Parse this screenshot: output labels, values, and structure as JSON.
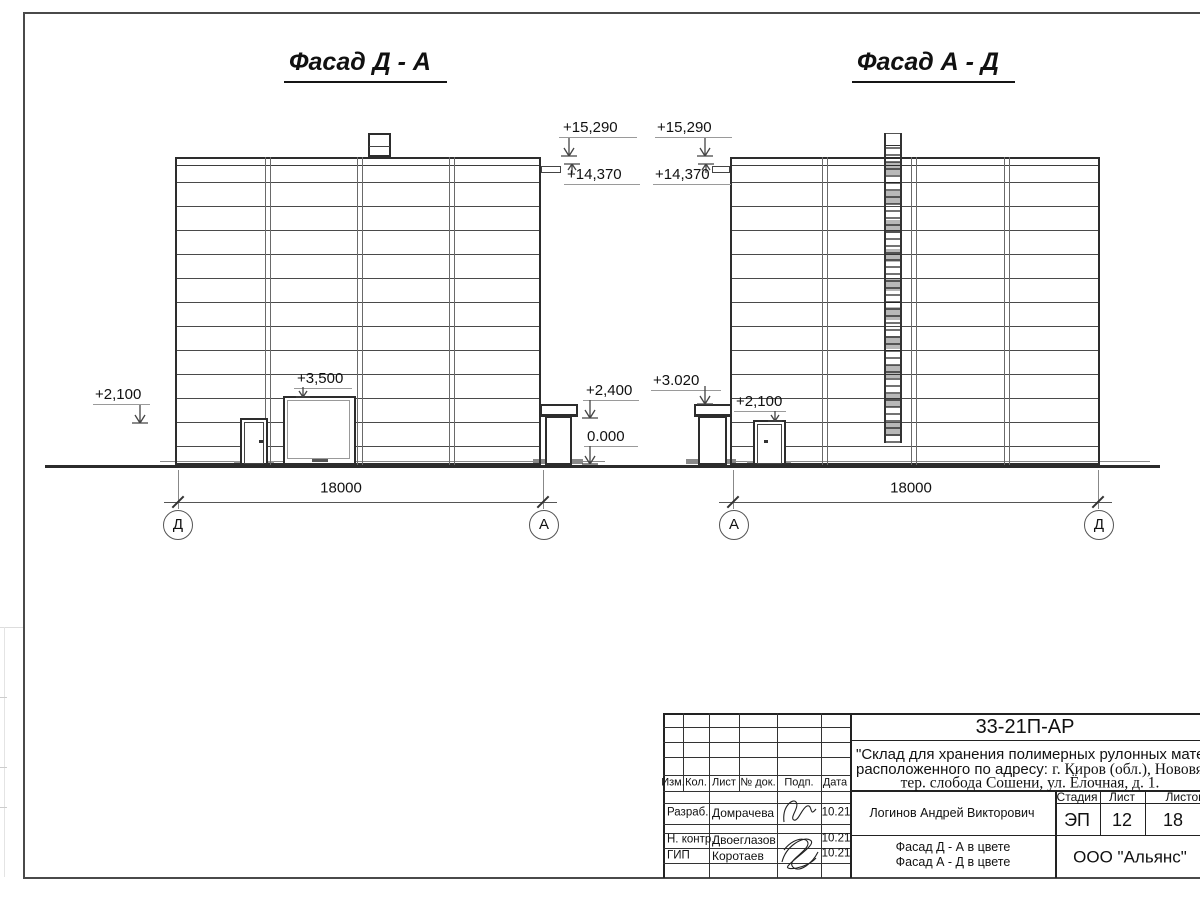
{
  "facades": {
    "left": {
      "title": "Фасад Д - А",
      "marks": {
        "e2100": "+2,100",
        "e3500": "+3,500",
        "e15290": "+15,290",
        "e14370": "+14,370",
        "e2400": "+2,400",
        "e0": "0.000"
      },
      "dim": "18000",
      "axes": {
        "left": "Д",
        "right": "А"
      }
    },
    "right": {
      "title": "Фасад А - Д",
      "marks": {
        "e15290": "+15,290",
        "e14370": "+14,370",
        "e3020": "+3.020",
        "e2100": "+2,100"
      },
      "dim": "18000",
      "axes": {
        "left": "А",
        "right": "Д"
      }
    }
  },
  "title_block": {
    "doc_code": "33-21П-АР",
    "project_line1": "\"Склад для хранения полимерных рулонных материалов",
    "project_line2a": "расположенного по адресу: ",
    "project_line2b": "г. Киров (обл.), Нововятский р-",
    "project_line3": "тер. слобода Сошени, ул. Ёлочная, д. 1.",
    "cols": {
      "izm": "Изм.",
      "kol": "Кол.",
      "list": "Лист",
      "doc": "№ док.",
      "podp": "Подп.",
      "data": "Дата"
    },
    "stage_header": {
      "stage": "Стадия",
      "sheet": "Лист",
      "sheets": "Листов"
    },
    "stage_values": {
      "stage": "ЭП",
      "sheet": "12",
      "sheets": "18"
    },
    "roles": [
      {
        "role": "Разраб.",
        "name": "Домрачева",
        "date": "10.21"
      },
      {
        "role": "Н. контр.",
        "name": "Двоеглазов",
        "date": "10.21"
      },
      {
        "role": "ГИП",
        "name": "Коротаев",
        "date": "10.21"
      }
    ],
    "chief": "Логинов Андрей Викторович",
    "sheet_title_line1": "Фасад Д - А в цвете",
    "sheet_title_line2": "Фасад А - Д в цвете",
    "company": "ООО \"Альянс\""
  }
}
